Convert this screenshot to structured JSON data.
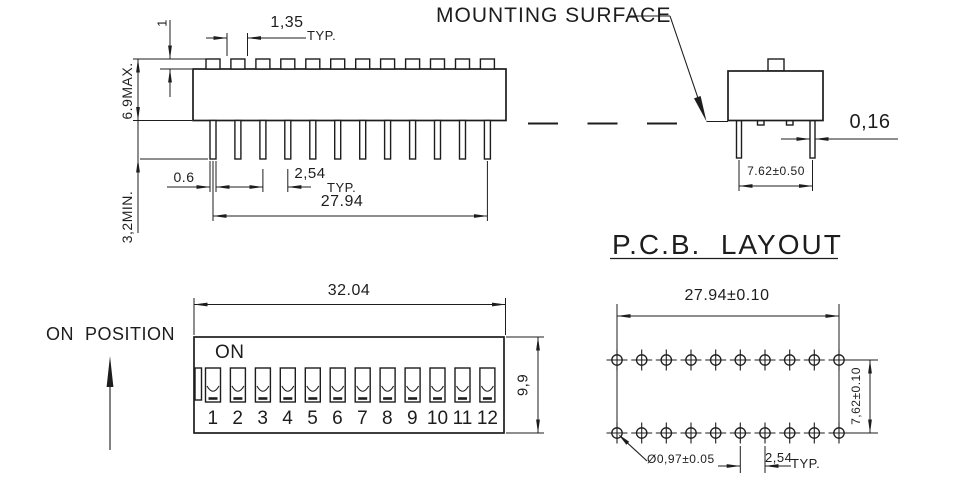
{
  "colors": {
    "ink": "#1d1d1d",
    "background": "#ffffff"
  },
  "side_view": {
    "bump_height": "1",
    "bump_width": "1,35",
    "bump_width_typ": "TYP.",
    "body_height": "6.9MAX.",
    "pin_min_length": "3,2MIN.",
    "pin_width": "0.6",
    "pin_pitch": "2,54",
    "pin_pitch_typ": "TYP.",
    "pin_span": "27.94"
  },
  "end_view": {
    "mounting_surface": "MOUNTING SURFACE",
    "pin_thickness": "0,16",
    "row_pitch": "7.62±0.50"
  },
  "front_view": {
    "on_position": "ON  POSITION",
    "on_label": "ON",
    "body_width": "32.04",
    "body_height": "9,9",
    "switch_numbers": [
      "1",
      "2",
      "3",
      "4",
      "5",
      "6",
      "7",
      "8",
      "9",
      "10",
      "11",
      "12"
    ]
  },
  "pcb_layout": {
    "title": "P.C.B.  LAYOUT",
    "hole_span": "27.94±0.10",
    "row_pitch": "7,62±0.10",
    "hole_diameter": "Ø0,97±0.05",
    "hole_pitch": "2,54",
    "hole_pitch_typ": "TYP."
  }
}
